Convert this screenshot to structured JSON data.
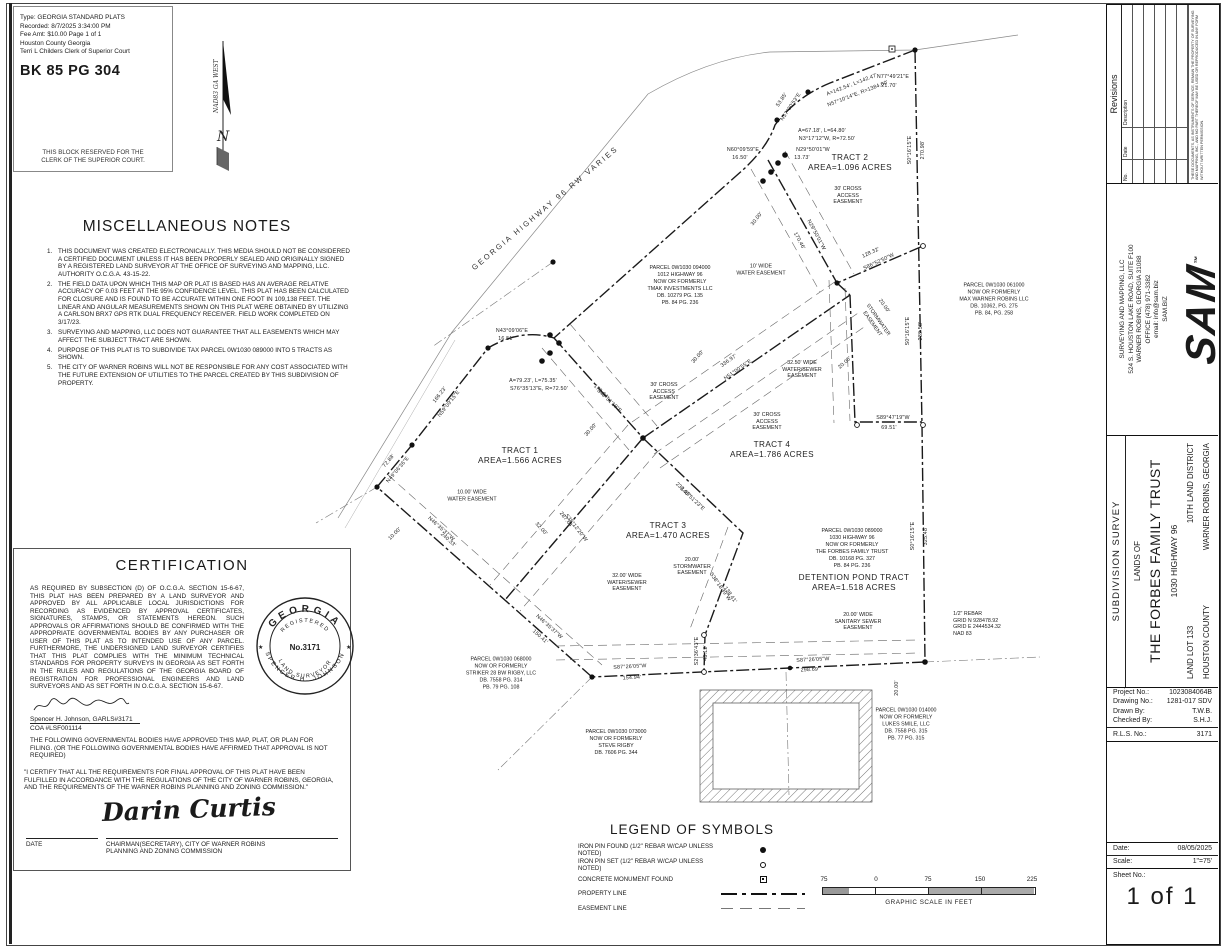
{
  "clerk_block": {
    "lines": [
      "Type:  GEORGIA STANDARD PLATS",
      "Recorded: 8/7/2025 3:34:00 PM",
      "Fee Amt: $10.00  Page 1 of 1",
      "Houston County Georgia",
      "Terri L Childers Clerk of Superior Court"
    ],
    "book_page": "BK 85  PG 304",
    "reserved": [
      "THIS BLOCK RESERVED FOR THE",
      "CLERK OF THE SUPERIOR COURT."
    ]
  },
  "north_arrow": {
    "datum": "NAD83 GA WEST",
    "letter": "N"
  },
  "misc_notes": {
    "title": "MISCELLANEOUS NOTES",
    "items": [
      "THIS DOCUMENT WAS CREATED ELECTRONICALLY. THIS MEDIA SHOULD NOT BE CONSIDERED A CERTIFIED DOCUMENT UNLESS IT HAS BEEN PROPERLY SEALED AND ORIGINALLY SIGNED BY A REGISTERED LAND SURVEYOR AT THE OFFICE OF SURVEYING AND MAPPING, LLC. AUTHORITY O.C.G.A. 43-15-22.",
      "THE FIELD DATA UPON WHICH THIS MAP OR PLAT IS BASED HAS AN AVERAGE RELATIVE ACCURACY OF 0.03 FEET AT THE 95% CONFIDENCE LEVEL. THIS PLAT HAS BEEN CALCULATED FOR CLOSURE AND IS FOUND TO BE ACCURATE WITHIN ONE FOOT IN 109,138 FEET. THE LINEAR AND ANGULAR MEASUREMENTS SHOWN ON THIS PLAT WERE OBTAINED BY UTILIZING A CARLSON BRX7 GPS RTK DUAL FREQUENCY RECEIVER. FIELD WORK COMPLETED ON 3/17/23.",
      "SURVEYING AND MAPPING, LLC DOES NOT GUARANTEE THAT ALL EASEMENTS WHICH MAY AFFECT THE SUBJECT TRACT ARE SHOWN.",
      "PURPOSE OF THIS PLAT IS TO SUBDIVIDE TAX PARCEL 0W1030 089000 INTO 5 TRACTS AS SHOWN.",
      "THE CITY OF WARNER ROBINS WILL NOT BE RESPONSIBLE FOR ANY COST ASSOCIATED WITH THE FUTURE EXTENSION OF UTILITIES TO THE PARCEL CREATED BY THIS SUBDIVISION OF PROPERTY."
    ]
  },
  "certification": {
    "title": "CERTIFICATION",
    "body": "AS REQUIRED BY SUBSECTION (D) OF O.C.G.A. SECTION 15-6-67, THIS PLAT HAS BEEN PREPARED BY A LAND SURVEYOR AND APPROVED BY ALL APPLICABLE LOCAL JURISDICTIONS FOR RECORDING AS EVIDENCED BY APPROVAL CERTIFICATES, SIGNATURES, STAMPS, OR STATEMENTS HEREON. SUCH APPROVALS OR AFFIRMATIONS SHOULD BE CONFIRMED WITH THE APPROPRIATE GOVERNMENTAL BODIES BY ANY PURCHASER OR USER OF THIS PLAT AS TO INTENDED USE OF ANY PARCEL.  FURTHERMORE, THE UNDERSIGNED LAND SURVEYOR CERTIFIES THAT THIS PLAT COMPLIES WITH THE MINIMUM TECHNICAL STANDARDS FOR PROPERTY SURVEYS IN GEORGIA AS SET FORTH IN THE RULES AND REGULATIONS OF THE GEORGIA BOARD OF REGISTRATION FOR PROFESSIONAL ENGINEERS AND LAND SURVEYORS AND AS SET FORTH IN O.C.G.A. SECTION 15-6-67.",
    "signer_name": "Spencer H. Johnson, GARLS#3171",
    "coa": "COA #LSF001114",
    "approval": "THE FOLLOWING GOVERNMENTAL BODIES HAVE APPROVED THIS MAP, PLAT, OR PLAN FOR FILING. (OR THE FOLLOWING GOVERNMENTAL BODIES HAVE AFFIRMED THAT APPROVAL IS NOT REQUIRED)",
    "final_statement": "\"I CERTIFY THAT ALL THE REQUIREMENTS FOR FINAL APPROVAL OF THIS PLAT HAVE BEEN FULFILLED IN ACCORDANCE WITH THE REGULATIONS OF THE CITY OF WARNER ROBINS, GEORGIA, AND THE REQUIREMENTS OF THE WARNER ROBINS PLANNING AND ZONING COMMISSION.\"",
    "signature": "Darin Curtis",
    "date_label": "DATE",
    "chairman_lines": [
      "CHAIRMAN(SECRETARY), CITY OF WARNER ROBINS",
      "PLANNING AND ZONING COMMISSION"
    ],
    "seal": {
      "state": "GEORGIA",
      "registered": "REGISTERED",
      "number": "No.3171",
      "surveyor": "SPENCER H. JOHNSON",
      "title": "LAND SURVEYOR",
      "star_left": "★",
      "star_right": "★"
    }
  },
  "legend": {
    "title": "LEGEND OF SYMBOLS",
    "items": [
      {
        "label": "IRON PIN FOUND (1/2\" REBAR W/CAP UNLESS NOTED)",
        "symbol": "pin-found"
      },
      {
        "label": "IRON PIN SET (1/2\" REBAR W/CAP UNLESS NOTED)",
        "symbol": "pin-set"
      },
      {
        "label": "CONCRETE MONUMENT FOUND",
        "symbol": "monument"
      },
      {
        "label": "PROPERTY LINE",
        "symbol": "property-line"
      },
      {
        "label": "EASEMENT LINE",
        "symbol": "easement-line"
      }
    ]
  },
  "scale_bar": {
    "ticks": [
      "75",
      "0",
      "75",
      "150",
      "225"
    ],
    "caption": "GRAPHIC SCALE IN FEET"
  },
  "sidebar": {
    "revisions": {
      "title": "Revisions",
      "columns": [
        "No.",
        "Date",
        "Description"
      ],
      "disclaimer": "THESE DOCUMENTS, AS INSTRUMENTS OF SERVICE, REMAIN THE PROPERTY OF SURVEYING AND MAPPING, INC., AND NO PART THEREOF MAY BE USED OR REPRODUCED IN ANY FORM WITHOUT WRITTEN PERMISSION."
    },
    "company": {
      "logo": "SAM",
      "tm": "™",
      "lines": [
        "SURVEYING AND MAPPING, LLC",
        "524 S. HOUSTON LAKE ROAD, SUITE F100",
        "WARNER ROBINS, GEORGIA 31088",
        "OFFICE (478) 971-3382",
        "email: info@sam.biz",
        "SAM.BIZ"
      ]
    },
    "title_block": {
      "survey_type": "SUBDIVISION SURVEY",
      "lands_of": "LANDS OF",
      "owner": "THE FORBES FAMILY TRUST",
      "address": "1030 HIGHWAY 96",
      "land_lot": "LAND LOT 133",
      "district": "10TH LAND DISTRICT",
      "county": "HOUSTON COUNTY",
      "city": "WARNER ROBINS, GEORGIA"
    },
    "project": {
      "rows": [
        {
          "label": "Project No.:",
          "value": "1023084064B"
        },
        {
          "label": "Drawing No.:",
          "value": "1281-017 SDV"
        },
        {
          "label": "Drawn By:",
          "value": "T.W.B."
        },
        {
          "label": "Checked By:",
          "value": "S.H.J."
        }
      ],
      "rls": {
        "label": "R.L.S. No.:",
        "value": "3171"
      },
      "date": {
        "label": "Date:",
        "value": "08/05/2025"
      },
      "scale": {
        "label": "Scale:",
        "value": "1\"=75'"
      },
      "sheet": {
        "label": "Sheet No.:",
        "value": "1 of 1"
      }
    }
  },
  "map": {
    "road_label": {
      "t": "GEORGIA HIGHWAY 96 RW VARIES",
      "x": 545,
      "y": 208,
      "r": -40
    },
    "tracts": [
      {
        "name": "TRACT 1",
        "area": "AREA=1.566 ACRES",
        "x": 520,
        "y": 456
      },
      {
        "name": "TRACT 2",
        "area": "AREA=1.096 ACRES",
        "x": 850,
        "y": 163
      },
      {
        "name": "TRACT 3",
        "area": "AREA=1.470 ACRES",
        "x": 668,
        "y": 531
      },
      {
        "name": "TRACT 4",
        "area": "AREA=1.786 ACRES",
        "x": 772,
        "y": 450
      },
      {
        "name": "DETENTION POND TRACT",
        "area": "AREA=1.518 ACRES",
        "x": 854,
        "y": 583
      }
    ],
    "parcels": [
      {
        "x": 680,
        "y": 286,
        "lines": [
          "PARCEL 0W1030 094000",
          "1012 HIGHWAY 96",
          "NOW OR FORMERLY",
          "TMAK INVESTMENTS LLC",
          "DB. 10279 PG. 135",
          "PB. 84 PG. 236"
        ]
      },
      {
        "x": 994,
        "y": 300,
        "lines": [
          "PARCEL 0W1030 061000",
          "NOW OR FORMERLY",
          "MAX WARNER ROBINS LLC",
          "DB. 10362, PG. 275",
          "PB. 84, PG. 258"
        ]
      },
      {
        "x": 852,
        "y": 549,
        "lines": [
          "PARCEL 0W1030 089000",
          "1030 HIGHWAY 96",
          "NOW OR FORMERLY",
          "THE FORBES FAMILY TRUST",
          "DB. 10168 PG. 327",
          "PB. 84 PG. 236"
        ]
      },
      {
        "x": 501,
        "y": 674,
        "lines": [
          "PARCEL 0W1030 068000",
          "NOW OR FORMERLY",
          "STRIKER 28 BW RIGBY, LLC",
          "DB. 7558 PG. 314",
          "PB. 79 PG. 108"
        ]
      },
      {
        "x": 616,
        "y": 743,
        "lines": [
          "PARCEL 0W1030 073000",
          "NOW OR FORMERLY",
          "STEVE RIGBY",
          "DB. 7606 PG. 344"
        ]
      },
      {
        "x": 906,
        "y": 725,
        "lines": [
          "PARCEL 0W1030 014000",
          "NOW OR FORMERLY",
          "LUKES SMILE, LLC",
          "DB. 7558 PG. 315",
          "PB. 77 PG. 315"
        ]
      }
    ],
    "easements": [
      {
        "x": 472,
        "y": 496,
        "lines": [
          "10.00' WIDE",
          "WATER EASEMENT"
        ]
      },
      {
        "x": 761,
        "y": 270,
        "lines": [
          "10' WIDE",
          "WATER EASEMENT"
        ]
      },
      {
        "x": 848,
        "y": 196,
        "lines": [
          "30' CROSS",
          "ACCESS",
          "EASEMENT"
        ]
      },
      {
        "x": 664,
        "y": 392,
        "lines": [
          "30' CROSS",
          "ACCESS",
          "EASEMENT"
        ]
      },
      {
        "x": 767,
        "y": 422,
        "lines": [
          "30' CROSS",
          "ACCESS",
          "EASEMENT"
        ]
      },
      {
        "x": 802,
        "y": 370,
        "lines": [
          "32.50' WIDE",
          "WATER/SEWER",
          "EASEMENT"
        ]
      },
      {
        "x": 627,
        "y": 583,
        "lines": [
          "32.00' WIDE",
          "WATER/SEWER",
          "EASEMENT"
        ]
      },
      {
        "x": 692,
        "y": 567,
        "lines": [
          "20.00'",
          "STORMWATER",
          "EASEMENT"
        ]
      },
      {
        "x": 858,
        "y": 622,
        "lines": [
          "20.00' WIDE",
          "SANITARY SEWER",
          "EASEMENT"
        ]
      },
      {
        "x": 875,
        "y": 322,
        "r": 55,
        "lines": [
          "STORMWATER",
          "EASEMENT"
        ]
      },
      {
        "x": 977,
        "y": 624,
        "align": "left",
        "lines": [
          "1/2\" REBAR",
          "GRID N 928478.92",
          "GRID E 2444534.32",
          "NAD 83"
        ]
      }
    ],
    "dims": [
      {
        "t": "A=142.54', L=142.47'",
        "x": 852,
        "y": 85,
        "r": -21
      },
      {
        "t": "N57°10'14\"E, R=1384.00'",
        "x": 858,
        "y": 94,
        "r": -21
      },
      {
        "t": "N77°49'21\"E",
        "x": 893,
        "y": 77,
        "r": 0
      },
      {
        "t": "21.70'",
        "x": 889,
        "y": 86,
        "r": 0
      },
      {
        "t": "53.85'",
        "x": 782,
        "y": 100,
        "r": -56
      },
      {
        "t": "N57°30'53\"E",
        "x": 791,
        "y": 107,
        "r": -56
      },
      {
        "t": "A=67.18', L=64.80'",
        "x": 822,
        "y": 131,
        "r": 0
      },
      {
        "t": "N3°17'12\"W, R=72.50'",
        "x": 827,
        "y": 139,
        "r": 0
      },
      {
        "t": "N29°50'01\"W",
        "x": 813,
        "y": 150,
        "r": 0
      },
      {
        "t": "13.73'",
        "x": 802,
        "y": 158,
        "r": 0
      },
      {
        "t": "N60°09'59\"E",
        "x": 743,
        "y": 150,
        "r": 0
      },
      {
        "t": "16.50'",
        "x": 740,
        "y": 158,
        "r": 0
      },
      {
        "t": "30.00'",
        "x": 757,
        "y": 219,
        "r": -52
      },
      {
        "t": "N29°50'01\"W",
        "x": 816,
        "y": 235,
        "r": 62
      },
      {
        "t": "170.46'",
        "x": 799,
        "y": 241,
        "r": 62
      },
      {
        "t": "S0°16'15\"E",
        "x": 910,
        "y": 150,
        "r": -90
      },
      {
        "t": "270.98'",
        "x": 923,
        "y": 150,
        "r": -90
      },
      {
        "t": "128.32'",
        "x": 871,
        "y": 253,
        "r": -25
      },
      {
        "t": "S86°52'50\"W",
        "x": 879,
        "y": 262,
        "r": -25
      },
      {
        "t": "S0°16'15\"E",
        "x": 908,
        "y": 331,
        "r": -90
      },
      {
        "t": "239.58'",
        "x": 921,
        "y": 331,
        "r": -90
      },
      {
        "t": "20.00'",
        "x": 884,
        "y": 306,
        "r": 55
      },
      {
        "t": "20.00'",
        "x": 845,
        "y": 363,
        "r": -42
      },
      {
        "t": "S89°47'19\"W",
        "x": 893,
        "y": 418,
        "r": 0
      },
      {
        "t": "69.51'",
        "x": 889,
        "y": 428,
        "r": 0
      },
      {
        "t": "S0°16'15\"E",
        "x": 913,
        "y": 536,
        "r": -90
      },
      {
        "t": "325.48'",
        "x": 926,
        "y": 536,
        "r": -90
      },
      {
        "t": "S87°26'05\"W",
        "x": 813,
        "y": 660,
        "r": -3
      },
      {
        "t": "298.69'",
        "x": 810,
        "y": 670,
        "r": -3
      },
      {
        "t": "S87°26'05\"W",
        "x": 630,
        "y": 667,
        "r": -3
      },
      {
        "t": "154.94'",
        "x": 632,
        "y": 678,
        "r": -3
      },
      {
        "t": "N46°35'37\"W",
        "x": 549,
        "y": 627,
        "r": 42
      },
      {
        "t": "150.41'",
        "x": 540,
        "y": 637,
        "r": 42
      },
      {
        "t": "S2°36'43\"E",
        "x": 697,
        "y": 651,
        "r": -90
      },
      {
        "t": "48.12'",
        "x": 706,
        "y": 653,
        "r": -90
      },
      {
        "t": "S38°18'39\"W",
        "x": 720,
        "y": 587,
        "r": 55
      },
      {
        "t": "138.41'",
        "x": 730,
        "y": 595,
        "r": 55
      },
      {
        "t": "232.15'",
        "x": 683,
        "y": 490,
        "r": 43
      },
      {
        "t": "S46°51'23\"E",
        "x": 692,
        "y": 499,
        "r": 43
      },
      {
        "t": "287.64'",
        "x": 566,
        "y": 520,
        "r": 52
      },
      {
        "t": "S38°12'20\"W",
        "x": 576,
        "y": 528,
        "r": 52
      },
      {
        "t": "32.00'",
        "x": 541,
        "y": 529,
        "r": 48
      },
      {
        "t": "30.00'",
        "x": 591,
        "y": 430,
        "r": -48
      },
      {
        "t": "30.00'",
        "x": 698,
        "y": 357,
        "r": -48
      },
      {
        "t": "173.64'",
        "x": 601,
        "y": 392,
        "r": 43
      },
      {
        "t": "S48°51'19\"E",
        "x": 609,
        "y": 401,
        "r": 43
      },
      {
        "t": "336.97'",
        "x": 729,
        "y": 361,
        "r": -35
      },
      {
        "t": "N51°00'55\"E",
        "x": 738,
        "y": 370,
        "r": -35
      },
      {
        "t": "N43°09'06\"E",
        "x": 512,
        "y": 331,
        "r": 0
      },
      {
        "t": "16.51'",
        "x": 506,
        "y": 339,
        "r": 0
      },
      {
        "t": "A=79.23', L=75.35'",
        "x": 533,
        "y": 381,
        "r": 0
      },
      {
        "t": "S76°35'13\"E, R=72.50'",
        "x": 539,
        "y": 389,
        "r": 0
      },
      {
        "t": "166.23'",
        "x": 440,
        "y": 395,
        "r": -52
      },
      {
        "t": "N59°09'15\"E",
        "x": 449,
        "y": 404,
        "r": -52
      },
      {
        "t": "72.88'",
        "x": 389,
        "y": 461,
        "r": -50
      },
      {
        "t": "N49°06'36\"E",
        "x": 398,
        "y": 470,
        "r": -50
      },
      {
        "t": "10.00'",
        "x": 395,
        "y": 534,
        "r": -45
      },
      {
        "t": "N46°35'37\"W",
        "x": 441,
        "y": 529,
        "r": 42
      },
      {
        "t": "240.33'",
        "x": 448,
        "y": 540,
        "r": 42
      },
      {
        "t": "20.00'",
        "x": 897,
        "y": 688,
        "r": -90
      }
    ]
  }
}
